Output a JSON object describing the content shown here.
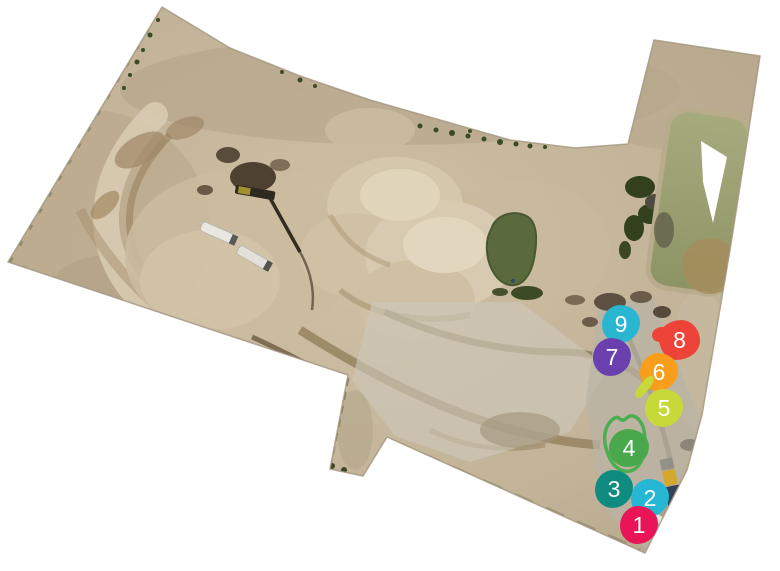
{
  "map": {
    "description": "Aerial drone orthomosaic of a quarry construction site with numbered annotations",
    "background": "#ffffff",
    "edge_color": "#a2967e",
    "marker_text_color": "#ffffff",
    "markers": [
      {
        "id": 1,
        "label": "1",
        "color": "#e91557",
        "x": 639,
        "y": 525
      },
      {
        "id": 2,
        "label": "2",
        "color": "#25b7d3",
        "x": 650,
        "y": 498
      },
      {
        "id": 3,
        "label": "3",
        "color": "#0f8c7f",
        "x": 614,
        "y": 489
      },
      {
        "id": 4,
        "label": "4",
        "color": "#4aa84c",
        "x": 628,
        "y": 448
      },
      {
        "id": 5,
        "label": "5",
        "color": "#c6d939",
        "x": 664,
        "y": 408
      },
      {
        "id": 6,
        "label": "6",
        "color": "#f99e1b",
        "x": 659,
        "y": 372
      },
      {
        "id": 7,
        "label": "7",
        "color": "#6a3fae",
        "x": 612,
        "y": 357
      },
      {
        "id": 8,
        "label": "8",
        "color": "#ee4338",
        "x": 680,
        "y": 340
      },
      {
        "id": 9,
        "label": "9",
        "color": "#28b6d0",
        "x": 621,
        "y": 324
      }
    ],
    "area_annotation": {
      "for_marker": "4",
      "color": "#4cae4f"
    }
  }
}
